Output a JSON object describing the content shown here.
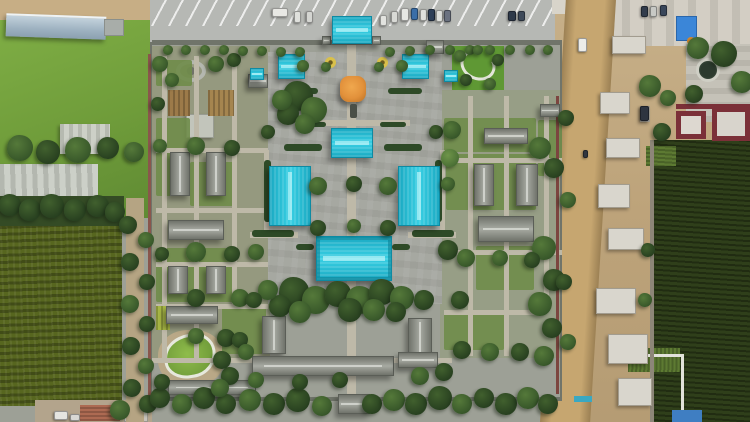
{
  "meta": {
    "title": "Aerial drone view of a walled Chinese temple complex with turquoise-roofed halls, an orange central pavilion, garden courtyards, a parking lot at top, farm fields to the left and a dirt road with buildings under construction to the right"
  },
  "scene": {
    "palette": {
      "plaza": "#9da096",
      "parking": "#b6b8b4",
      "cyan": "#38d0e4",
      "orange": "#e2913b",
      "road": "#c6a670",
      "dirt": "#c7ae85",
      "crop": "#2f3f1a",
      "maroon": "#7b3038",
      "blue": "#3b86d8",
      "redroof": "#ad6a52"
    },
    "cyan_roofs": [
      [
        332,
        16,
        40,
        28,
        "h",
        "main-gate"
      ],
      [
        278,
        54,
        27,
        25,
        "h",
        "west-pavilion"
      ],
      [
        402,
        54,
        27,
        25,
        "h",
        "east-pavilion"
      ],
      [
        250,
        68,
        14,
        12,
        "h",
        "west-kiosk"
      ],
      [
        444,
        70,
        14,
        12,
        "h",
        "east-kiosk"
      ],
      [
        331,
        128,
        42,
        30,
        "h",
        "middle-hall"
      ],
      [
        269,
        166,
        42,
        60,
        "v",
        "west-hall"
      ],
      [
        398,
        166,
        42,
        60,
        "v",
        "east-hall"
      ],
      [
        316,
        236,
        76,
        45,
        "h",
        "main-hall"
      ]
    ],
    "gray_roofs": [
      [
        170,
        152,
        20,
        44,
        "v"
      ],
      [
        206,
        152,
        20,
        44,
        "v"
      ],
      [
        248,
        74,
        20,
        14,
        "h"
      ],
      [
        426,
        40,
        18,
        14,
        "h"
      ],
      [
        168,
        220,
        56,
        20,
        "h"
      ],
      [
        168,
        266,
        20,
        28,
        "v"
      ],
      [
        206,
        266,
        20,
        28,
        "v"
      ],
      [
        166,
        306,
        52,
        18,
        "h"
      ],
      [
        484,
        128,
        44,
        16,
        "h"
      ],
      [
        474,
        164,
        20,
        42,
        "v"
      ],
      [
        516,
        164,
        22,
        42,
        "v"
      ],
      [
        478,
        216,
        56,
        26,
        "h"
      ],
      [
        540,
        104,
        20,
        13,
        "h"
      ],
      [
        262,
        316,
        24,
        38,
        "v"
      ],
      [
        408,
        318,
        24,
        40,
        "v"
      ],
      [
        252,
        356,
        142,
        20,
        "h"
      ],
      [
        168,
        380,
        88,
        15,
        "h"
      ],
      [
        398,
        352,
        40,
        16,
        "h"
      ],
      [
        338,
        394,
        32,
        20,
        "h"
      ],
      [
        322,
        36,
        9,
        9,
        "h"
      ],
      [
        372,
        36,
        9,
        9,
        "h"
      ]
    ],
    "paths": [
      [
        347,
        44,
        9,
        356
      ],
      [
        296,
        120,
        114,
        6
      ],
      [
        300,
        296,
        110,
        6
      ],
      [
        250,
        232,
        48,
        6
      ],
      [
        408,
        232,
        48,
        6
      ],
      [
        162,
        56,
        5,
        302
      ],
      [
        194,
        56,
        5,
        302
      ],
      [
        232,
        56,
        5,
        248
      ],
      [
        156,
        148,
        112,
        5
      ],
      [
        156,
        208,
        112,
        5
      ],
      [
        156,
        262,
        112,
        5
      ],
      [
        156,
        304,
        112,
        5
      ],
      [
        468,
        96,
        5,
        260
      ],
      [
        504,
        96,
        5,
        260
      ],
      [
        544,
        96,
        5,
        214
      ],
      [
        444,
        158,
        118,
        5
      ],
      [
        444,
        250,
        118,
        5
      ],
      [
        444,
        310,
        96,
        5
      ],
      [
        264,
        150,
        5,
        84
      ],
      [
        440,
        150,
        5,
        84
      ],
      [
        152,
        358,
        300,
        5
      ]
    ],
    "lawns": [
      [
        156,
        60,
        36,
        26
      ],
      [
        156,
        118,
        34,
        78
      ],
      [
        190,
        162,
        46,
        44
      ],
      [
        156,
        248,
        78,
        54
      ],
      [
        222,
        306,
        44,
        48
      ],
      [
        444,
        118,
        92,
        34
      ],
      [
        446,
        154,
        90,
        56
      ],
      [
        476,
        246,
        58,
        44
      ],
      [
        538,
        120,
        24,
        56
      ],
      [
        444,
        310,
        60,
        40
      ]
    ],
    "garden_beds": [
      [
        168,
        90,
        22,
        26,
        "#9c7a49"
      ],
      [
        208,
        90,
        26,
        26,
        "#a5854f"
      ],
      [
        156,
        306,
        14,
        24,
        "#a8b845"
      ]
    ],
    "hedges": [
      [
        284,
        144,
        38,
        7
      ],
      [
        384,
        144,
        38,
        7
      ],
      [
        284,
        88,
        34,
        6
      ],
      [
        388,
        88,
        34,
        6
      ],
      [
        252,
        230,
        42,
        7
      ],
      [
        412,
        230,
        42,
        7
      ],
      [
        300,
        122,
        26,
        5
      ],
      [
        380,
        122,
        26,
        5
      ],
      [
        264,
        160,
        7,
        62
      ],
      [
        435,
        160,
        7,
        62
      ],
      [
        296,
        244,
        18,
        6
      ],
      [
        392,
        244,
        18,
        6
      ]
    ],
    "bars": [
      [
        148,
        54,
        3,
        348,
        "#8a564c"
      ],
      [
        556,
        96,
        3,
        298,
        "#7c453f"
      ],
      [
        152,
        40,
        410,
        5,
        "#70746a"
      ],
      [
        152,
        397,
        410,
        4,
        "#70746a"
      ],
      [
        650,
        140,
        4,
        282,
        "#8d8678"
      ]
    ],
    "blocks": [
      [
        612,
        36,
        34,
        18
      ],
      [
        600,
        92,
        30,
        22
      ],
      [
        606,
        138,
        34,
        20
      ],
      [
        598,
        184,
        32,
        24
      ],
      [
        608,
        228,
        36,
        22
      ],
      [
        596,
        288,
        40,
        26
      ],
      [
        608,
        334,
        40,
        30
      ],
      [
        618,
        378,
        34,
        28
      ],
      [
        640,
        106,
        10,
        16
      ]
    ],
    "cars": [
      [
        272,
        8,
        16,
        9,
        "#e8e8e4"
      ],
      [
        294,
        11,
        7,
        12,
        "#dfe0dc"
      ],
      [
        306,
        11,
        7,
        12,
        "#d4d5d1"
      ],
      [
        380,
        15,
        7,
        11,
        "#e2e3df"
      ],
      [
        391,
        11,
        7,
        12,
        "#d8d9d5"
      ],
      [
        401,
        8,
        8,
        13,
        "#e6e7e3"
      ],
      [
        411,
        8,
        7,
        12,
        "#3a6ea8"
      ],
      [
        420,
        9,
        7,
        12,
        "#dfe0dc"
      ],
      [
        428,
        9,
        7,
        12,
        "#2e3f57"
      ],
      [
        436,
        10,
        7,
        12,
        "#dfe0dc"
      ],
      [
        444,
        10,
        7,
        12,
        "#6b7280"
      ],
      [
        508,
        11,
        8,
        10,
        "#2e3a4a"
      ],
      [
        518,
        11,
        7,
        10,
        "#3e4a5a"
      ],
      [
        641,
        6,
        7,
        11,
        "#323c4c"
      ],
      [
        650,
        6,
        7,
        11,
        "#c8c9c5"
      ],
      [
        660,
        5,
        7,
        11,
        "#39465a"
      ],
      [
        578,
        38,
        9,
        14,
        "#ecece8"
      ],
      [
        583,
        150,
        5,
        8,
        "#30363f"
      ],
      [
        640,
        106,
        9,
        15,
        "#2e3440"
      ],
      [
        54,
        411,
        14,
        9,
        "#e4e4e0"
      ],
      [
        70,
        414,
        10,
        7,
        "#d8d8d4"
      ]
    ],
    "trees": [
      [
        20,
        148,
        13,
        1
      ],
      [
        48,
        152,
        12,
        0
      ],
      [
        78,
        150,
        13,
        1
      ],
      [
        108,
        148,
        11,
        0
      ],
      [
        134,
        152,
        10,
        1
      ],
      [
        10,
        205,
        11,
        0
      ],
      [
        30,
        210,
        11,
        0
      ],
      [
        52,
        206,
        12,
        0
      ],
      [
        75,
        210,
        11,
        0
      ],
      [
        98,
        206,
        11,
        0
      ],
      [
        115,
        212,
        10,
        0
      ],
      [
        128,
        225,
        9,
        0
      ],
      [
        146,
        240,
        8,
        1
      ],
      [
        130,
        262,
        9,
        0
      ],
      [
        147,
        282,
        8,
        0
      ],
      [
        130,
        304,
        9,
        1
      ],
      [
        147,
        324,
        8,
        0
      ],
      [
        131,
        346,
        9,
        0
      ],
      [
        146,
        366,
        8,
        1
      ],
      [
        132,
        388,
        9,
        0
      ],
      [
        148,
        404,
        9,
        0
      ],
      [
        120,
        410,
        10,
        1
      ],
      [
        160,
        64,
        8,
        1
      ],
      [
        172,
        80,
        7,
        1
      ],
      [
        158,
        104,
        7,
        0
      ],
      [
        216,
        64,
        8,
        1
      ],
      [
        234,
        60,
        7,
        0
      ],
      [
        168,
        50,
        5,
        1
      ],
      [
        186,
        50,
        5,
        1
      ],
      [
        205,
        50,
        5,
        1
      ],
      [
        224,
        50,
        5,
        1
      ],
      [
        243,
        51,
        5,
        1
      ],
      [
        262,
        51,
        5,
        1
      ],
      [
        281,
        52,
        5,
        1
      ],
      [
        300,
        52,
        5,
        1
      ],
      [
        390,
        52,
        5,
        1
      ],
      [
        410,
        51,
        5,
        1
      ],
      [
        430,
        50,
        5,
        1
      ],
      [
        450,
        50,
        5,
        1
      ],
      [
        470,
        50,
        5,
        1
      ],
      [
        490,
        50,
        5,
        1
      ],
      [
        510,
        50,
        5,
        1
      ],
      [
        530,
        50,
        5,
        1
      ],
      [
        548,
        50,
        5,
        1
      ],
      [
        298,
        96,
        15,
        0
      ],
      [
        314,
        110,
        13,
        1
      ],
      [
        288,
        114,
        11,
        0
      ],
      [
        305,
        124,
        10,
        1
      ],
      [
        282,
        100,
        10,
        1
      ],
      [
        303,
        66,
        6,
        1
      ],
      [
        326,
        67,
        5,
        1
      ],
      [
        379,
        67,
        5,
        1
      ],
      [
        402,
        66,
        6,
        1
      ],
      [
        268,
        132,
        7,
        0
      ],
      [
        436,
        132,
        7,
        0
      ],
      [
        318,
        186,
        9,
        1
      ],
      [
        354,
        184,
        8,
        0
      ],
      [
        388,
        186,
        9,
        1
      ],
      [
        318,
        228,
        8,
        0
      ],
      [
        388,
        228,
        8,
        0
      ],
      [
        354,
        226,
        7,
        1
      ],
      [
        450,
        158,
        9,
        2
      ],
      [
        448,
        184,
        7,
        1
      ],
      [
        294,
        292,
        15,
        0
      ],
      [
        316,
        300,
        14,
        1
      ],
      [
        338,
        294,
        13,
        0
      ],
      [
        360,
        300,
        14,
        1
      ],
      [
        382,
        292,
        13,
        0
      ],
      [
        402,
        298,
        12,
        1
      ],
      [
        280,
        306,
        11,
        0
      ],
      [
        300,
        312,
        11,
        1
      ],
      [
        350,
        310,
        12,
        0
      ],
      [
        374,
        310,
        11,
        1
      ],
      [
        396,
        312,
        10,
        0
      ],
      [
        424,
        300,
        10,
        0
      ],
      [
        268,
        290,
        10,
        1
      ],
      [
        196,
        146,
        9,
        1
      ],
      [
        232,
        148,
        8,
        0
      ],
      [
        160,
        146,
        7,
        1
      ],
      [
        196,
        252,
        10,
        1
      ],
      [
        232,
        254,
        8,
        0
      ],
      [
        162,
        254,
        7,
        0
      ],
      [
        196,
        298,
        9,
        0
      ],
      [
        240,
        298,
        9,
        1
      ],
      [
        226,
        338,
        9,
        0
      ],
      [
        196,
        336,
        8,
        1
      ],
      [
        240,
        340,
        8,
        0
      ],
      [
        256,
        252,
        8,
        1
      ],
      [
        254,
        300,
        8,
        0
      ],
      [
        452,
        130,
        9,
        1
      ],
      [
        540,
        148,
        11,
        1
      ],
      [
        554,
        168,
        10,
        0
      ],
      [
        448,
        250,
        10,
        0
      ],
      [
        466,
        258,
        9,
        1
      ],
      [
        544,
        248,
        12,
        1
      ],
      [
        554,
        280,
        11,
        0
      ],
      [
        540,
        304,
        12,
        1
      ],
      [
        552,
        328,
        10,
        0
      ],
      [
        460,
        300,
        9,
        0
      ],
      [
        500,
        258,
        8,
        1
      ],
      [
        532,
        260,
        8,
        0
      ],
      [
        544,
        356,
        10,
        1
      ],
      [
        520,
        352,
        9,
        0
      ],
      [
        490,
        352,
        9,
        1
      ],
      [
        462,
        350,
        9,
        0
      ],
      [
        160,
        398,
        10,
        0
      ],
      [
        182,
        404,
        10,
        1
      ],
      [
        204,
        398,
        11,
        0
      ],
      [
        226,
        404,
        10,
        0
      ],
      [
        250,
        400,
        11,
        1
      ],
      [
        274,
        404,
        11,
        0
      ],
      [
        298,
        400,
        12,
        0
      ],
      [
        322,
        406,
        10,
        1
      ],
      [
        372,
        404,
        10,
        0
      ],
      [
        394,
        400,
        11,
        1
      ],
      [
        416,
        404,
        11,
        0
      ],
      [
        440,
        398,
        12,
        0
      ],
      [
        462,
        404,
        10,
        1
      ],
      [
        484,
        398,
        10,
        0
      ],
      [
        506,
        404,
        11,
        0
      ],
      [
        528,
        398,
        11,
        1
      ],
      [
        548,
        404,
        10,
        0
      ],
      [
        230,
        376,
        9,
        0
      ],
      [
        256,
        380,
        8,
        1
      ],
      [
        300,
        382,
        8,
        0
      ],
      [
        340,
        380,
        8,
        0
      ],
      [
        420,
        376,
        9,
        1
      ],
      [
        444,
        372,
        9,
        0
      ],
      [
        222,
        360,
        9,
        0
      ],
      [
        246,
        352,
        8,
        1
      ],
      [
        162,
        382,
        8,
        0
      ],
      [
        220,
        388,
        9,
        1
      ],
      [
        566,
        118,
        8,
        0
      ],
      [
        568,
        200,
        8,
        1
      ],
      [
        564,
        282,
        8,
        0
      ],
      [
        568,
        342,
        8,
        1
      ],
      [
        650,
        86,
        11,
        1
      ],
      [
        662,
        132,
        9,
        0
      ],
      [
        698,
        48,
        11,
        1
      ],
      [
        724,
        54,
        13,
        0
      ],
      [
        742,
        82,
        11,
        1
      ],
      [
        694,
        94,
        9,
        0
      ],
      [
        668,
        98,
        8,
        1
      ],
      [
        648,
        250,
        7,
        0
      ],
      [
        645,
        300,
        7,
        1
      ],
      [
        460,
        56,
        6,
        1
      ],
      [
        478,
        50,
        5,
        1
      ],
      [
        498,
        60,
        6,
        0
      ],
      [
        466,
        80,
        6,
        0
      ],
      [
        490,
        84,
        6,
        1
      ]
    ]
  }
}
